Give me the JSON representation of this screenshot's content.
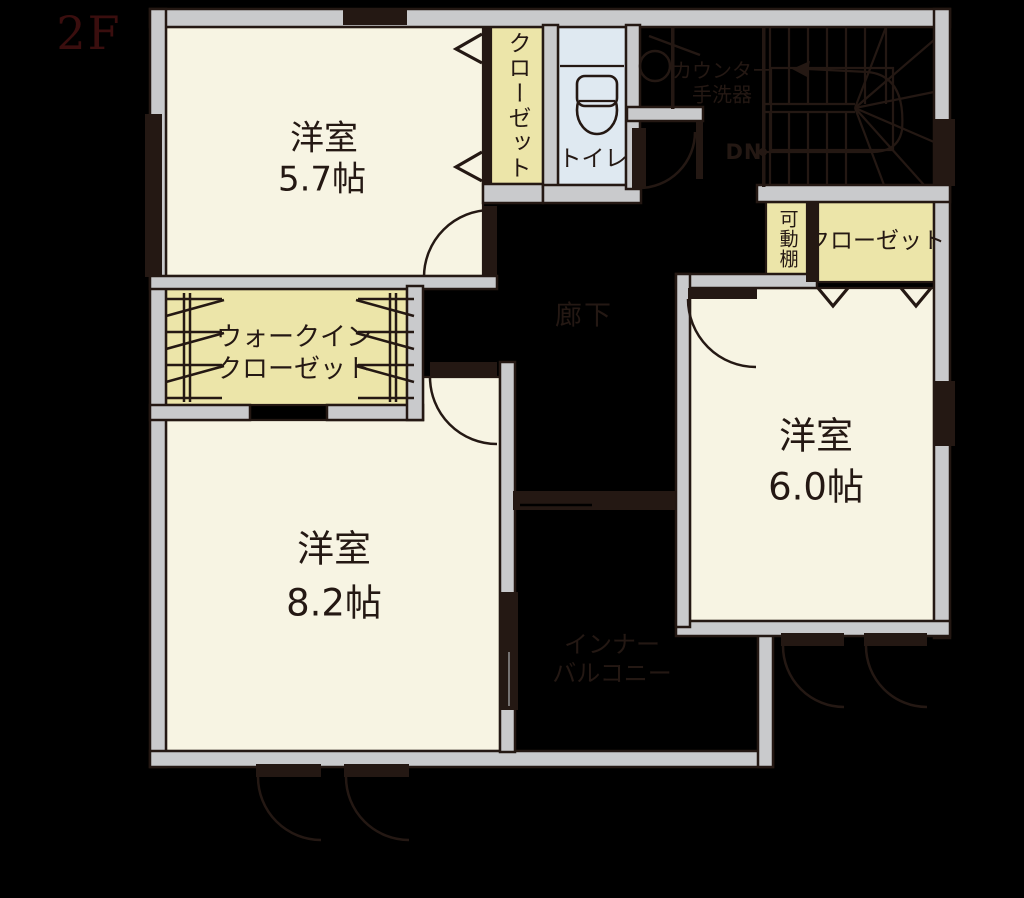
{
  "floor_label": "2F",
  "colors": {
    "background": "#000000",
    "wall_fill": "#c9cacc",
    "line": "#241813",
    "room_fill": "#f7f4e3",
    "closet_fill": "#ece5a9",
    "toilet_fill": "#dfe9f1",
    "floor_label_color": "#3a0e0e"
  },
  "labels": {
    "room57_name": "洋室",
    "room57_size": "5.7帖",
    "room82_name": "洋室",
    "room82_size": "8.2帖",
    "room60_name": "洋室",
    "room60_size": "6.0帖",
    "closet_57": "クローゼット",
    "closet_60": "クローゼット",
    "movable_shelf": "可動棚",
    "walk_in_closet": "ウォークイン\nクローゼット",
    "toilet": "トイレ",
    "counter_basin": "カウンター\n手洗器",
    "hallway": "廊下",
    "inner_balcony": "インナー\nバルコニー",
    "stairs_down": "DN"
  }
}
